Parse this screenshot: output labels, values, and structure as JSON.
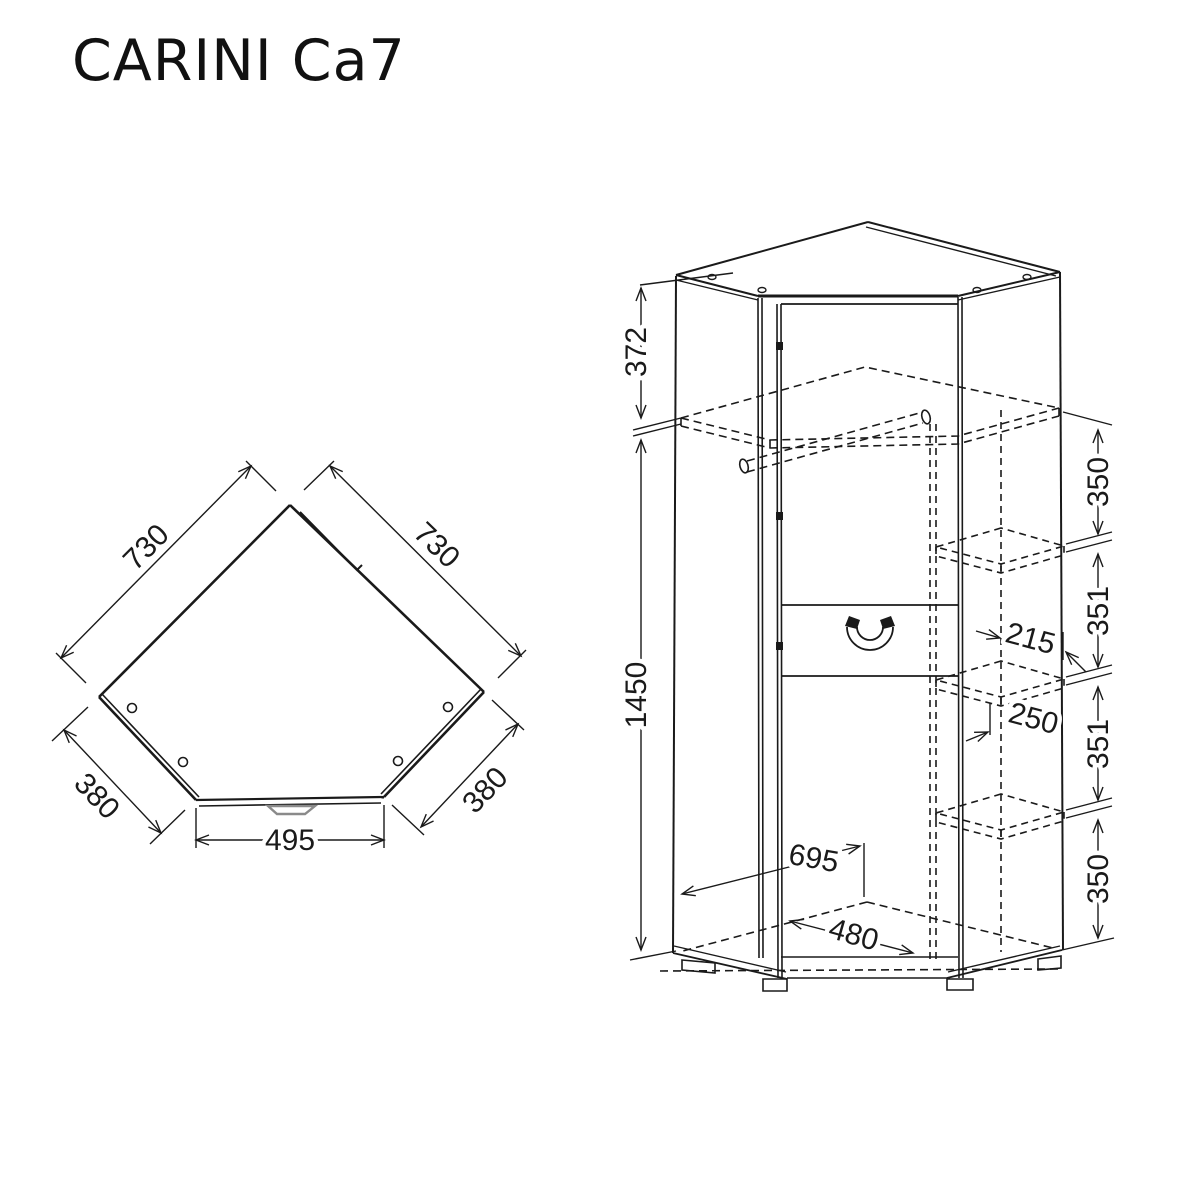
{
  "title": "CARINI Ca7",
  "colors": {
    "line": "#1a1a1a",
    "background": "#ffffff",
    "foot_gray": "#8a8a8a"
  },
  "plan_view": {
    "name": "top-view-corner-wardrobe",
    "dims": {
      "left_side": "730",
      "right_side": "730",
      "left_depth": "380",
      "right_depth": "380",
      "front_width": "495"
    }
  },
  "front_view": {
    "name": "front-perspective-view",
    "dims": {
      "top_section": "372",
      "body_height": "1450",
      "gap_1": "350",
      "gap_2": "351",
      "gap_3": "351",
      "gap_4": "350",
      "shelf_inset": "215",
      "shelf_width": "250",
      "interior_width": "695",
      "interior_diagonal": "480"
    }
  }
}
